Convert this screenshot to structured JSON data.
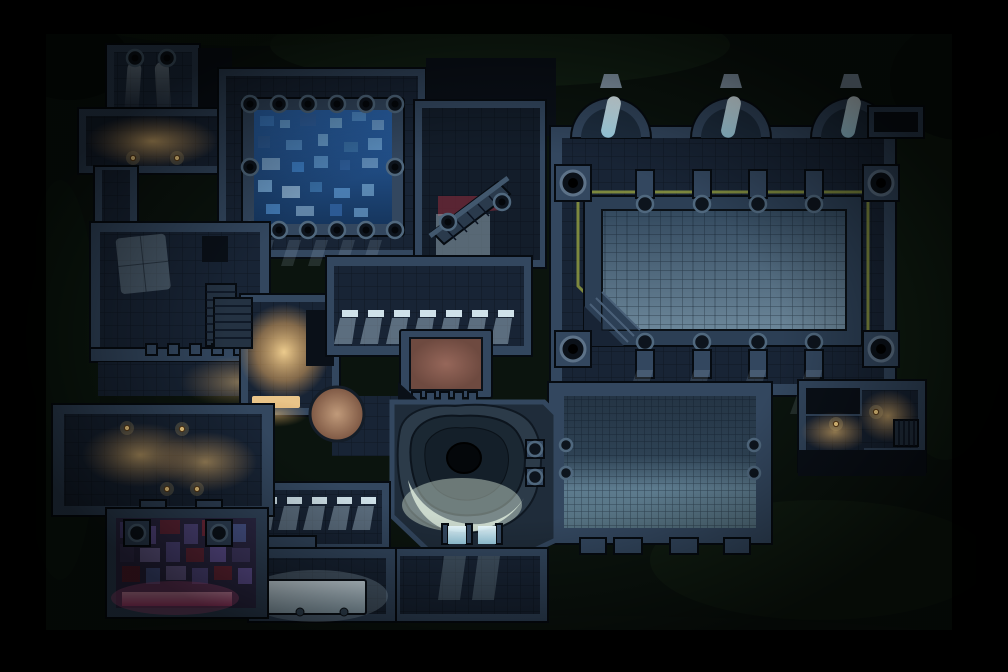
{
  "meta": {
    "asset_type": "top-down dungeon battle map",
    "style": "dark stone dungeon at night, square tile grid, mixed cold moonlight and warm candle light",
    "canvas": {
      "width_px": 1008,
      "height_px": 672
    }
  },
  "colors": {
    "bg-black": "#020305",
    "bg-green": "#0b140e",
    "bg-green-light": "#142417",
    "wall": "#33475f",
    "wall-light": "#4a6078",
    "wall-dark": "#0a1018",
    "outline": "#060b11",
    "floor": "#182435",
    "floor-light": "#22334a",
    "cold-light": "#cfe8f4",
    "moon-light": "#bcd7e6",
    "water-deep": "#1b4a82",
    "water-mid": "#3f7fc4",
    "water-light": "#9cc6e4",
    "amber-core": "#e8bd72",
    "amber-glow": "#c9955a",
    "flame": "#ffd98a",
    "trim-yellow": "#8f9a3f",
    "maroon": "#6b2836",
    "dais-brown": "#875d50",
    "table-tan": "#b3886b",
    "purple-tile": "#5c5190",
    "magenta": "#c9548e",
    "pink-bright": "#e898b4",
    "pit-rock": "#2c3b49",
    "pit-rock-dark": "#1b2833",
    "pit-lit": "#d9e7d9",
    "hole-black": "#04070a"
  },
  "features": [
    {
      "name": "chapel-room",
      "label": "Top-left vertical room with two round pillars and moonlight beams"
    },
    {
      "name": "moonlight-beams",
      "label": "Two pale light shafts falling between the chapel pillars"
    },
    {
      "name": "lantern-hall",
      "label": "Wide amber-lit hall below the chapel with two candles"
    },
    {
      "name": "reservoir-room",
      "label": "Room holding the raised water pool"
    },
    {
      "name": "water-pool",
      "label": "Raised pool filled with blue mosaic water"
    },
    {
      "name": "pool-pillar-ring",
      "label": "Ring of fourteen round pillars on the pool rim"
    },
    {
      "name": "study-room",
      "label": "Left-middle room with a projected window light and a dark doorway"
    },
    {
      "name": "stairs-down-west",
      "label": "Straight staircase on the right side of the study room"
    },
    {
      "name": "hearth-room",
      "label": "Small brightly amber-lit room left of center with glowing south doorway"
    },
    {
      "name": "round-table",
      "label": "Large round tan table south-east of the hearth room"
    },
    {
      "name": "window-corridor",
      "label": "Central corridor with a row of seven lit window slits and light pools"
    },
    {
      "name": "dais-platform",
      "label": "Raised stone dais with red-brown top and toothed south edge"
    },
    {
      "name": "grand-stair",
      "label": "Diagonal staircase with railing, maroon floor patch and pale landing"
    },
    {
      "name": "grand-hall",
      "label": "Large eastern hall with three arched window alcoves"
    },
    {
      "name": "arch-windows",
      "label": "Three glowing slanted windows inside the arched alcoves"
    },
    {
      "name": "ceremonial-platform",
      "label": "Huge raised platform in the hall ringed by a yellow trim line"
    },
    {
      "name": "corner-pillars",
      "label": "Four massive round corner pillars of the platform"
    },
    {
      "name": "wall-posts",
      "label": "Rows of small square posts on the north and south platform edges"
    },
    {
      "name": "barracks-room",
      "label": "Large south-eastern room, brighter toward its south half, toothed south wall"
    },
    {
      "name": "side-rooms-east",
      "label": "Two small candle-lit rooms at the far east with a small stair"
    },
    {
      "name": "window-gallery",
      "label": "Bottom-center room with five pooled window lights"
    },
    {
      "name": "banquet-room",
      "label": "Bottom-center room with a pale glowing rectangular platform"
    },
    {
      "name": "shrine-room",
      "label": "Bottom-left room tiled in purple and magenta mosaic with a glowing pink strip"
    },
    {
      "name": "great-hall-west",
      "label": "Wide amber-lit room at the bottom left with four candles"
    },
    {
      "name": "cave-pit",
      "label": "Central natural cavern pit spiraling into a black hole, lit pale from the south"
    },
    {
      "name": "pit-doorways",
      "label": "Two glowing door lights on the south rim of the pit"
    },
    {
      "name": "undercroft",
      "label": "Room south of the pit catching two beams of cold light"
    },
    {
      "name": "background-terrain",
      "label": "Mottled dark-green cavern rock surrounding the dungeon"
    },
    {
      "name": "vignette",
      "label": "Black vignette framing the whole map"
    }
  ]
}
